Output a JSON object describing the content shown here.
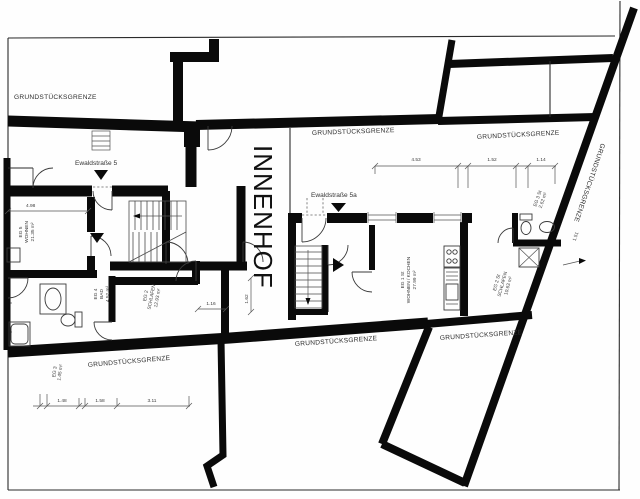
{
  "labels": {
    "boundary": "GRUNDSTÜCKSGRENZE",
    "innenhof": "INNENHOF",
    "street5": "Ewaldstraße 5",
    "street5a": "Ewaldstraße 5a"
  },
  "rooms": {
    "eg5": {
      "line1": "EG 5",
      "line2": "WOHNEN",
      "line3": "21.35 m²"
    },
    "eg4": {
      "line1": "EG 4",
      "line2": "BAD",
      "line3": "4.52 m²"
    },
    "eg2": {
      "line1": "EG 2",
      "line2": "SCHLAFEN",
      "line3": "12.93 m²"
    },
    "eg1st": {
      "line1": "EG 1 St",
      "line2": "WOHNEN / KOCHEN",
      "line3": "27.99 m²"
    },
    "eg2st": {
      "line1": "EG 2 St",
      "line2": "SCHLAFEN",
      "line3": "10.63 m²"
    },
    "eg3st": {
      "line1": "EG 3 St",
      "line2": "2.62 m²"
    },
    "eg3": {
      "line1": "EG 3",
      "line2": "1.45 m²"
    }
  },
  "dimensions": {
    "top1": "4.53",
    "top2": "1.52",
    "top3": "1.14",
    "bottom1": "1.48",
    "bottom2": "1.58",
    "bottom3": "3.11",
    "left1": "4.98",
    "mid1": "1.16",
    "mid2": "1.62",
    "diag1": "1.51"
  }
}
